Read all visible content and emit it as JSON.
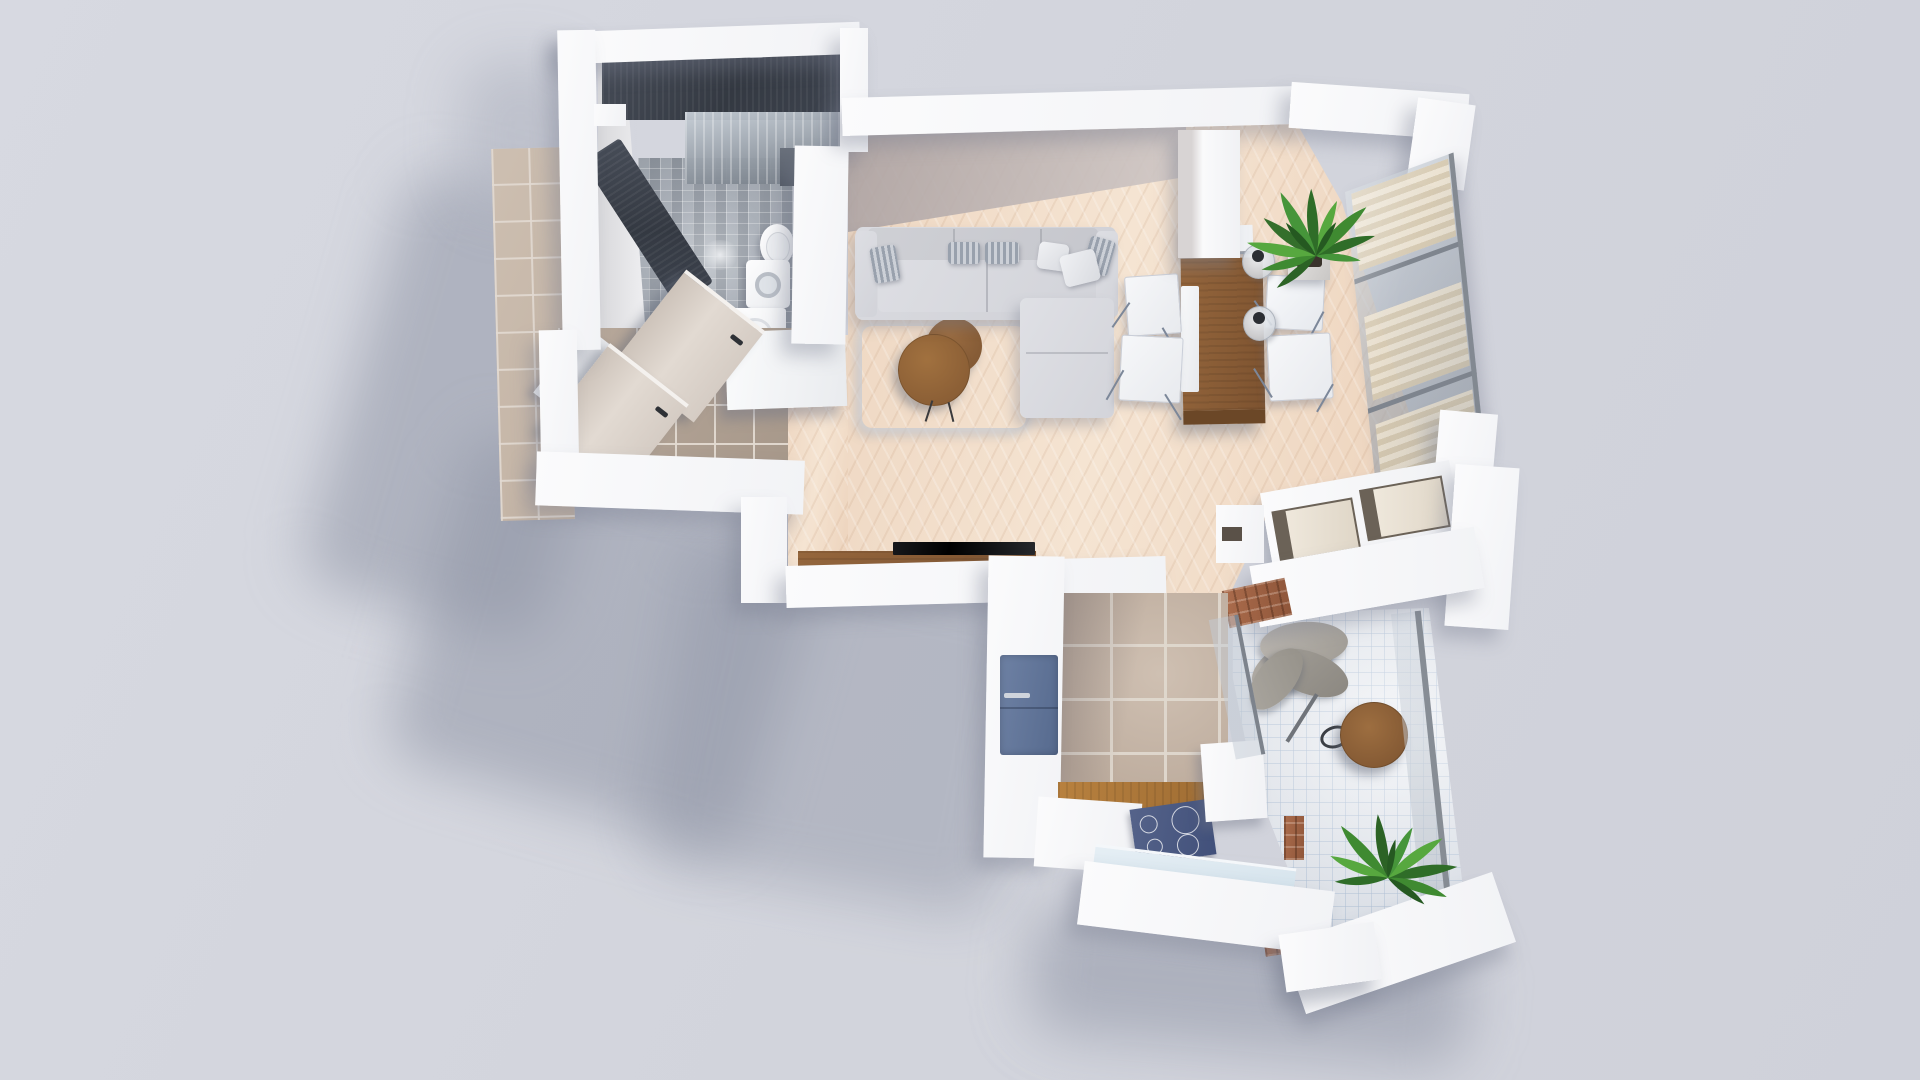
{
  "scene": {
    "type": "3d-floor-plan-render",
    "view": "top-down axonometric",
    "title": "Studio apartment 3D floor plan render",
    "background_color": "#d3d5dd"
  },
  "palette": {
    "background": "#d3d5dd",
    "wall_white": "#f7f8fa",
    "soft_shadow": "#9096a6",
    "herringbone_wood": "#f0dbc6",
    "hallway_tile": "#b3a496",
    "entrance_mat_tile": "#c9bbad",
    "kitchen_tile": "#c3b4a6",
    "balcony_tile": "#eef0f4",
    "bathroom_mosaic": "#a7adb5",
    "shower_stone": "#3b4049",
    "sofa_gray": "#d7d8dc",
    "table_wood": "#8f6239",
    "counter_wood": "#b07c3f",
    "fridge_blue": "#64779a",
    "cooktop_navy": "#4a5878",
    "tv_black": "#0b0c0e",
    "plant_green": "#3c8030",
    "glass_gray": "#aab3bd",
    "curtain_cream": "#e6dcc8",
    "brick": "#a4684a"
  },
  "rooms": {
    "bathroom": {
      "label": "Bathroom",
      "floor": "grey mosaic tile",
      "items": [
        "walk-in shower",
        "dark stone shower wall",
        "glass shower screen",
        "shower head",
        "wall-hung toilet",
        "washing machine",
        "vanity cabinet",
        "swing door"
      ]
    },
    "hallway": {
      "label": "Hallway",
      "floor": "taupe ceramic tile",
      "items": [
        "entrance door",
        "white door panel",
        "tall wardrobe",
        "tiled entrance mat"
      ]
    },
    "living_room": {
      "label": "Living room",
      "floor": "herringbone oak",
      "items": [
        "L-shaped corner sofa",
        "striped cushions",
        "white cushions",
        "shaggy grey rug",
        "two round wooden coffee tables",
        "wall-mounted TV",
        "wooden media console"
      ]
    },
    "dining": {
      "label": "Dining area",
      "items": [
        "rectangular wooden table",
        "white bench runner",
        "4 white folding chairs",
        "2 glass pendant lamps",
        "potted palm plant",
        "white sideboard unit"
      ]
    },
    "kitchen": {
      "label": "Kitchen",
      "floor": "beige square tile",
      "items": [
        "blue refrigerator",
        "induction hob with 4 rings",
        "wooden countertop",
        "white cabinets",
        "glazed south window"
      ]
    },
    "balcony": {
      "label": "Balcony",
      "floor": "white mosaic tile",
      "items": [
        "hanging egg chair",
        "round wooden bistro table",
        "potted palm plant",
        "glass railing",
        "brick wall accents",
        "white parapet walls"
      ]
    },
    "storage": {
      "label": "Storage console",
      "items": [
        "open shelving console with cream dividers"
      ]
    },
    "window_wall": {
      "label": "Glazed window wall",
      "items": [
        "grey mullions",
        "sheer cream curtains",
        "white corner pillars"
      ]
    }
  }
}
